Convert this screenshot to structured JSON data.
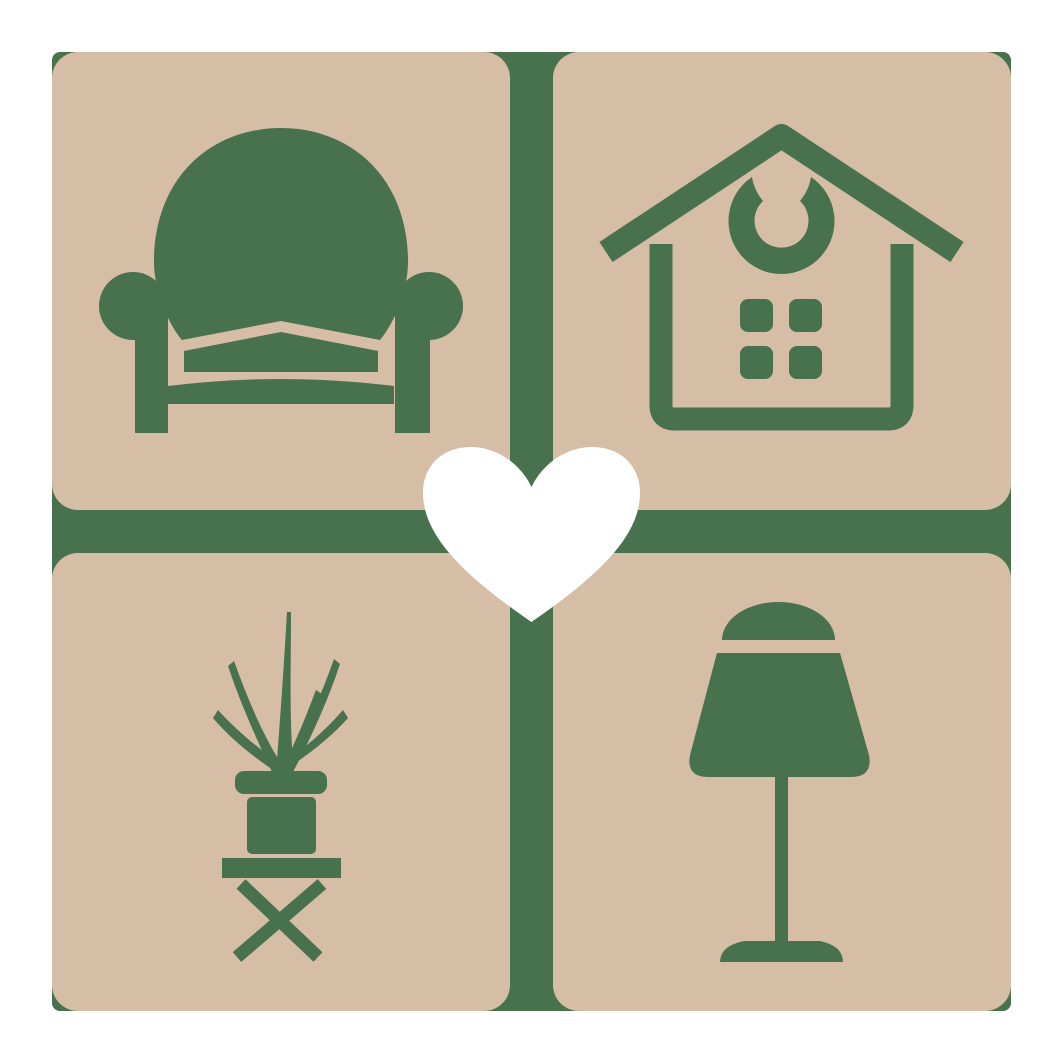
{
  "logo": {
    "center_symbol": "heart",
    "tiles": [
      {
        "position": "top-left",
        "icon": "armchair"
      },
      {
        "position": "top-right",
        "icon": "house"
      },
      {
        "position": "bottom-left",
        "icon": "potted-plant"
      },
      {
        "position": "bottom-right",
        "icon": "table-lamp"
      }
    ]
  },
  "colors": {
    "green": "#48714E",
    "beige": "#D6BDA5",
    "heart_white": "#FFFFFF",
    "background": "#FFFFFF"
  }
}
